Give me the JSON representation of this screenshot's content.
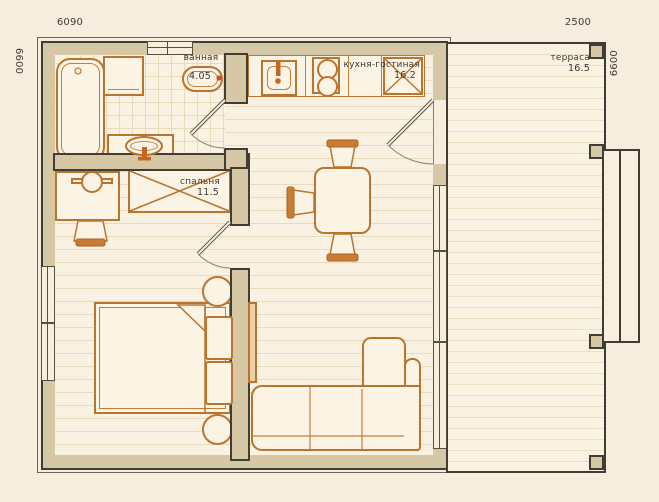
{
  "plan_title": "floor-plan",
  "dimensions": {
    "house_width": "6090",
    "terrace_width": "2500",
    "left_height": "6600",
    "right_height": "6600"
  },
  "rooms": {
    "bathroom": {
      "label": "ванная",
      "area": "4.05"
    },
    "kitchen_living": {
      "label": "кухня-гостиная",
      "area": "16.2"
    },
    "bedroom": {
      "label": "спальня",
      "area": "11.5"
    },
    "terrace": {
      "label": "терраса",
      "area": "16.5"
    }
  },
  "colors": {
    "background": "#f7edde",
    "wall_fill": "#d6c8a4",
    "wall_outline": "#413c34",
    "furniture_accent": "#b9742f",
    "floor": "#f9f1e1",
    "text": "#3b3733"
  }
}
